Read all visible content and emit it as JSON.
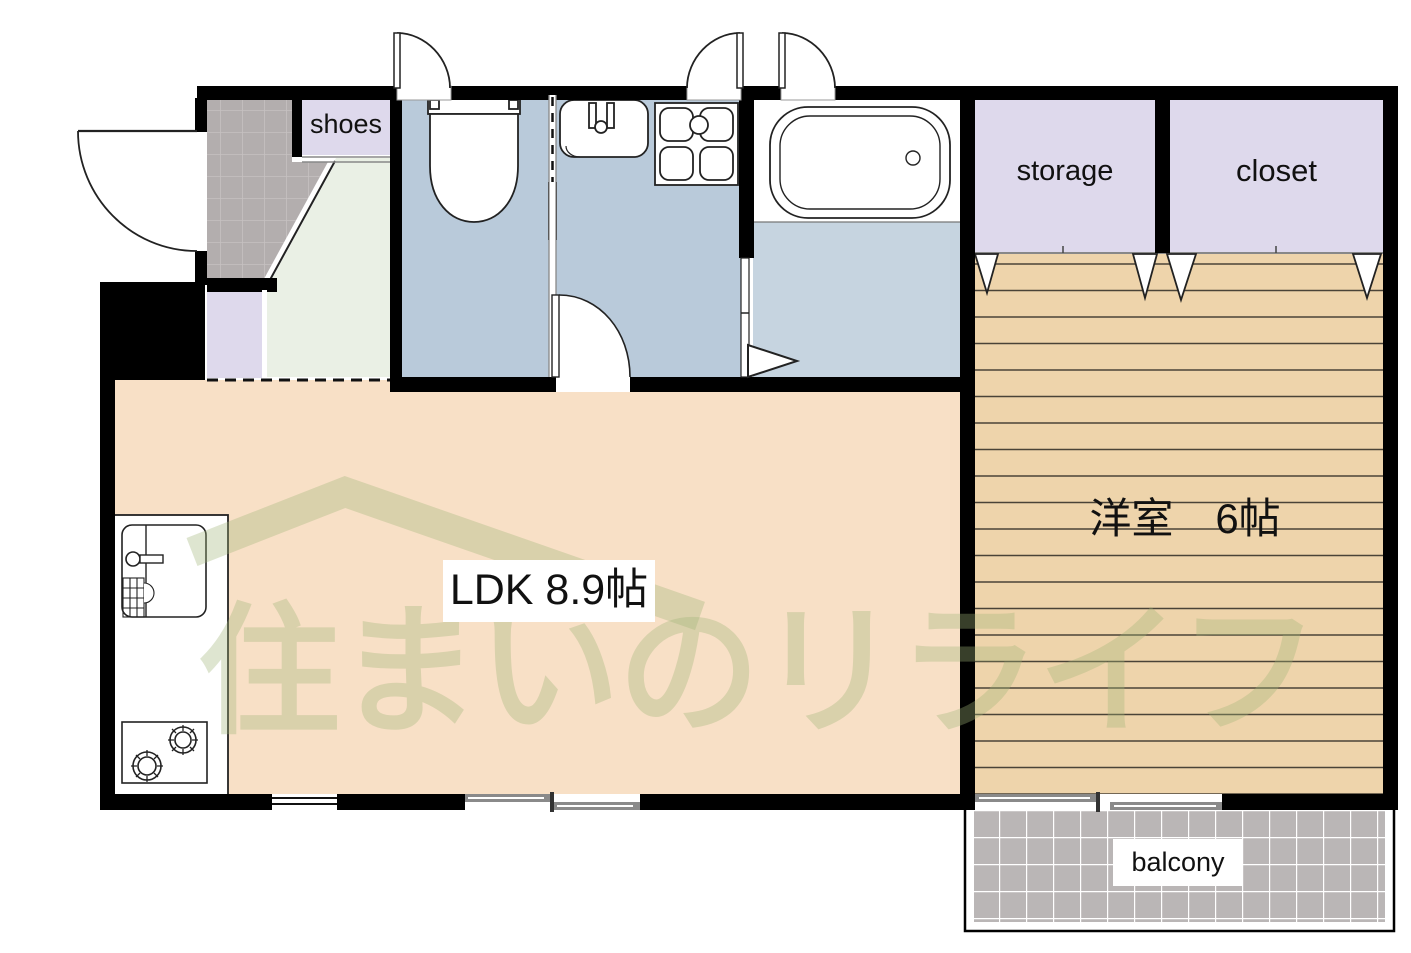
{
  "rooms": {
    "shoes": "shoes",
    "storage": "storage",
    "closet": "closet",
    "balcony": "balcony",
    "ldk": "LDK 8.9帖",
    "western_room": "洋室　6帖"
  },
  "watermark": {
    "text": "住まいのリライフ"
  },
  "palette": {
    "wall": "#000000",
    "wet_room_floor": "#b9cada",
    "bath_floor": "#c6d4e0",
    "ldk_floor": "#f8e0c6",
    "wood_floor": "#eed4ab",
    "closet_fill": "#ded9ec",
    "hall_floor": "#eaf0e5",
    "entrance_tile_gray": "#b3aeae",
    "balcony_gray": "#bab6b6",
    "watermark_green": "rgba(160,180,120,0.35)"
  }
}
